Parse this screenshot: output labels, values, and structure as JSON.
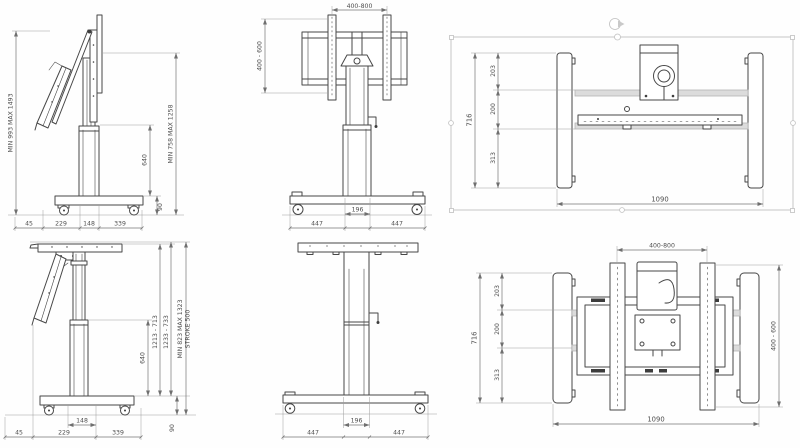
{
  "document": {
    "type": "technical-drawing",
    "subject": "height-adjustable mobile TV trolley / lift stand, six orthographic views with dimensions (mm)"
  },
  "views": {
    "side_elevated": {
      "height_overall": "MIN 993 MAX 1493",
      "height_mount": "MIN 758 MAX 1258",
      "column": "640",
      "base_height": "90",
      "depth_segments": [
        "45",
        "229",
        "148",
        "339"
      ]
    },
    "front_elevated": {
      "vesa_width": "400-800",
      "vesa_height": "400 - 600",
      "base_segments": [
        "447",
        "196",
        "447"
      ]
    },
    "top_plan": {
      "depth_overall": "716",
      "depth_segments": [
        "203",
        "200",
        "313"
      ],
      "width": "1090"
    },
    "side_lowered": {
      "range_inner": "1213 - 713",
      "range_mid": "1233 - 733",
      "range_outer_line1": "MIN 823 MAX 1323",
      "range_outer_line2": "STROKE 500",
      "column": "640",
      "column_width": "148",
      "base_height": "90",
      "depth_segments": [
        "45",
        "229",
        "339"
      ]
    },
    "front_lowered": {
      "base_segments": [
        "447",
        "196",
        "447"
      ]
    },
    "rear_mount": {
      "vesa_width": "400-800",
      "depth_overall": "716",
      "depth_segments": [
        "203",
        "200",
        "313"
      ],
      "vesa_height": "400 - 600",
      "width": "1090"
    }
  }
}
